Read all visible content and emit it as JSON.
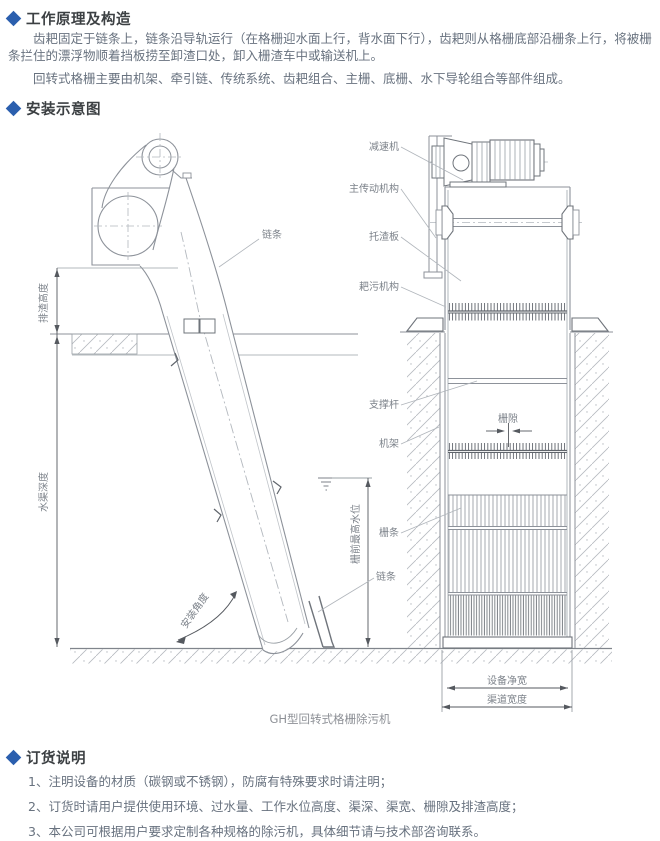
{
  "colors": {
    "accent": "#2b5fae",
    "heading_text": "#3c4043",
    "body_text": "#68727f",
    "drawing_line": "#8d929a",
    "drawing_light": "#aab0b7",
    "drawing_dark": "#55595f",
    "label_text": "#7c828a"
  },
  "intro": {
    "heading": "工作原理及构造",
    "para1": "齿耙固定于链条上，链条沿导轨运行（在格栅迎水面上行，背水面下行），齿耙则从格栅底部沿栅条上行，将被栅条拦住的漂浮物顺着挡板捞至卸渣口处，卸入栅渣车中或输送机上。",
    "para2": "回转式格栅主要由机架、牵引链、传统系统、齿耙组合、主栅、底栅、水下导轮组合等部件组成。"
  },
  "install": {
    "heading": "安装示意图",
    "caption": "GH型回转式格栅除污机",
    "labels": {
      "chain_top": "链条",
      "discharge_height": "排渣高度",
      "channel_depth": "水渠深度",
      "front_max_water_level": "栅前最高水位",
      "install_angle": "安装角度",
      "reducer": "减速机",
      "main_drive": "主传动机构",
      "slag_tray": "托渣板",
      "rake_mechanism": "耙污机构",
      "support_rod": "支撑杆",
      "frame": "机架",
      "grid_gap": "栅隙",
      "grid_bar": "栅条",
      "chain_bottom": "链条",
      "equipment_net_width": "设备净宽",
      "channel_width": "渠道宽度"
    }
  },
  "ordering": {
    "heading": "订货说明",
    "items": [
      "1、注明设备的材质（碳钢或不锈钢），防腐有特殊要求时请注明；",
      "2、订货时请用户提供使用环境、过水量、工作水位高度、渠深、渠宽、栅隙及排渣高度；",
      "3、本公司可根据用户要求定制各种规格的除污机，具体细节请与技术部咨询联系。"
    ]
  }
}
